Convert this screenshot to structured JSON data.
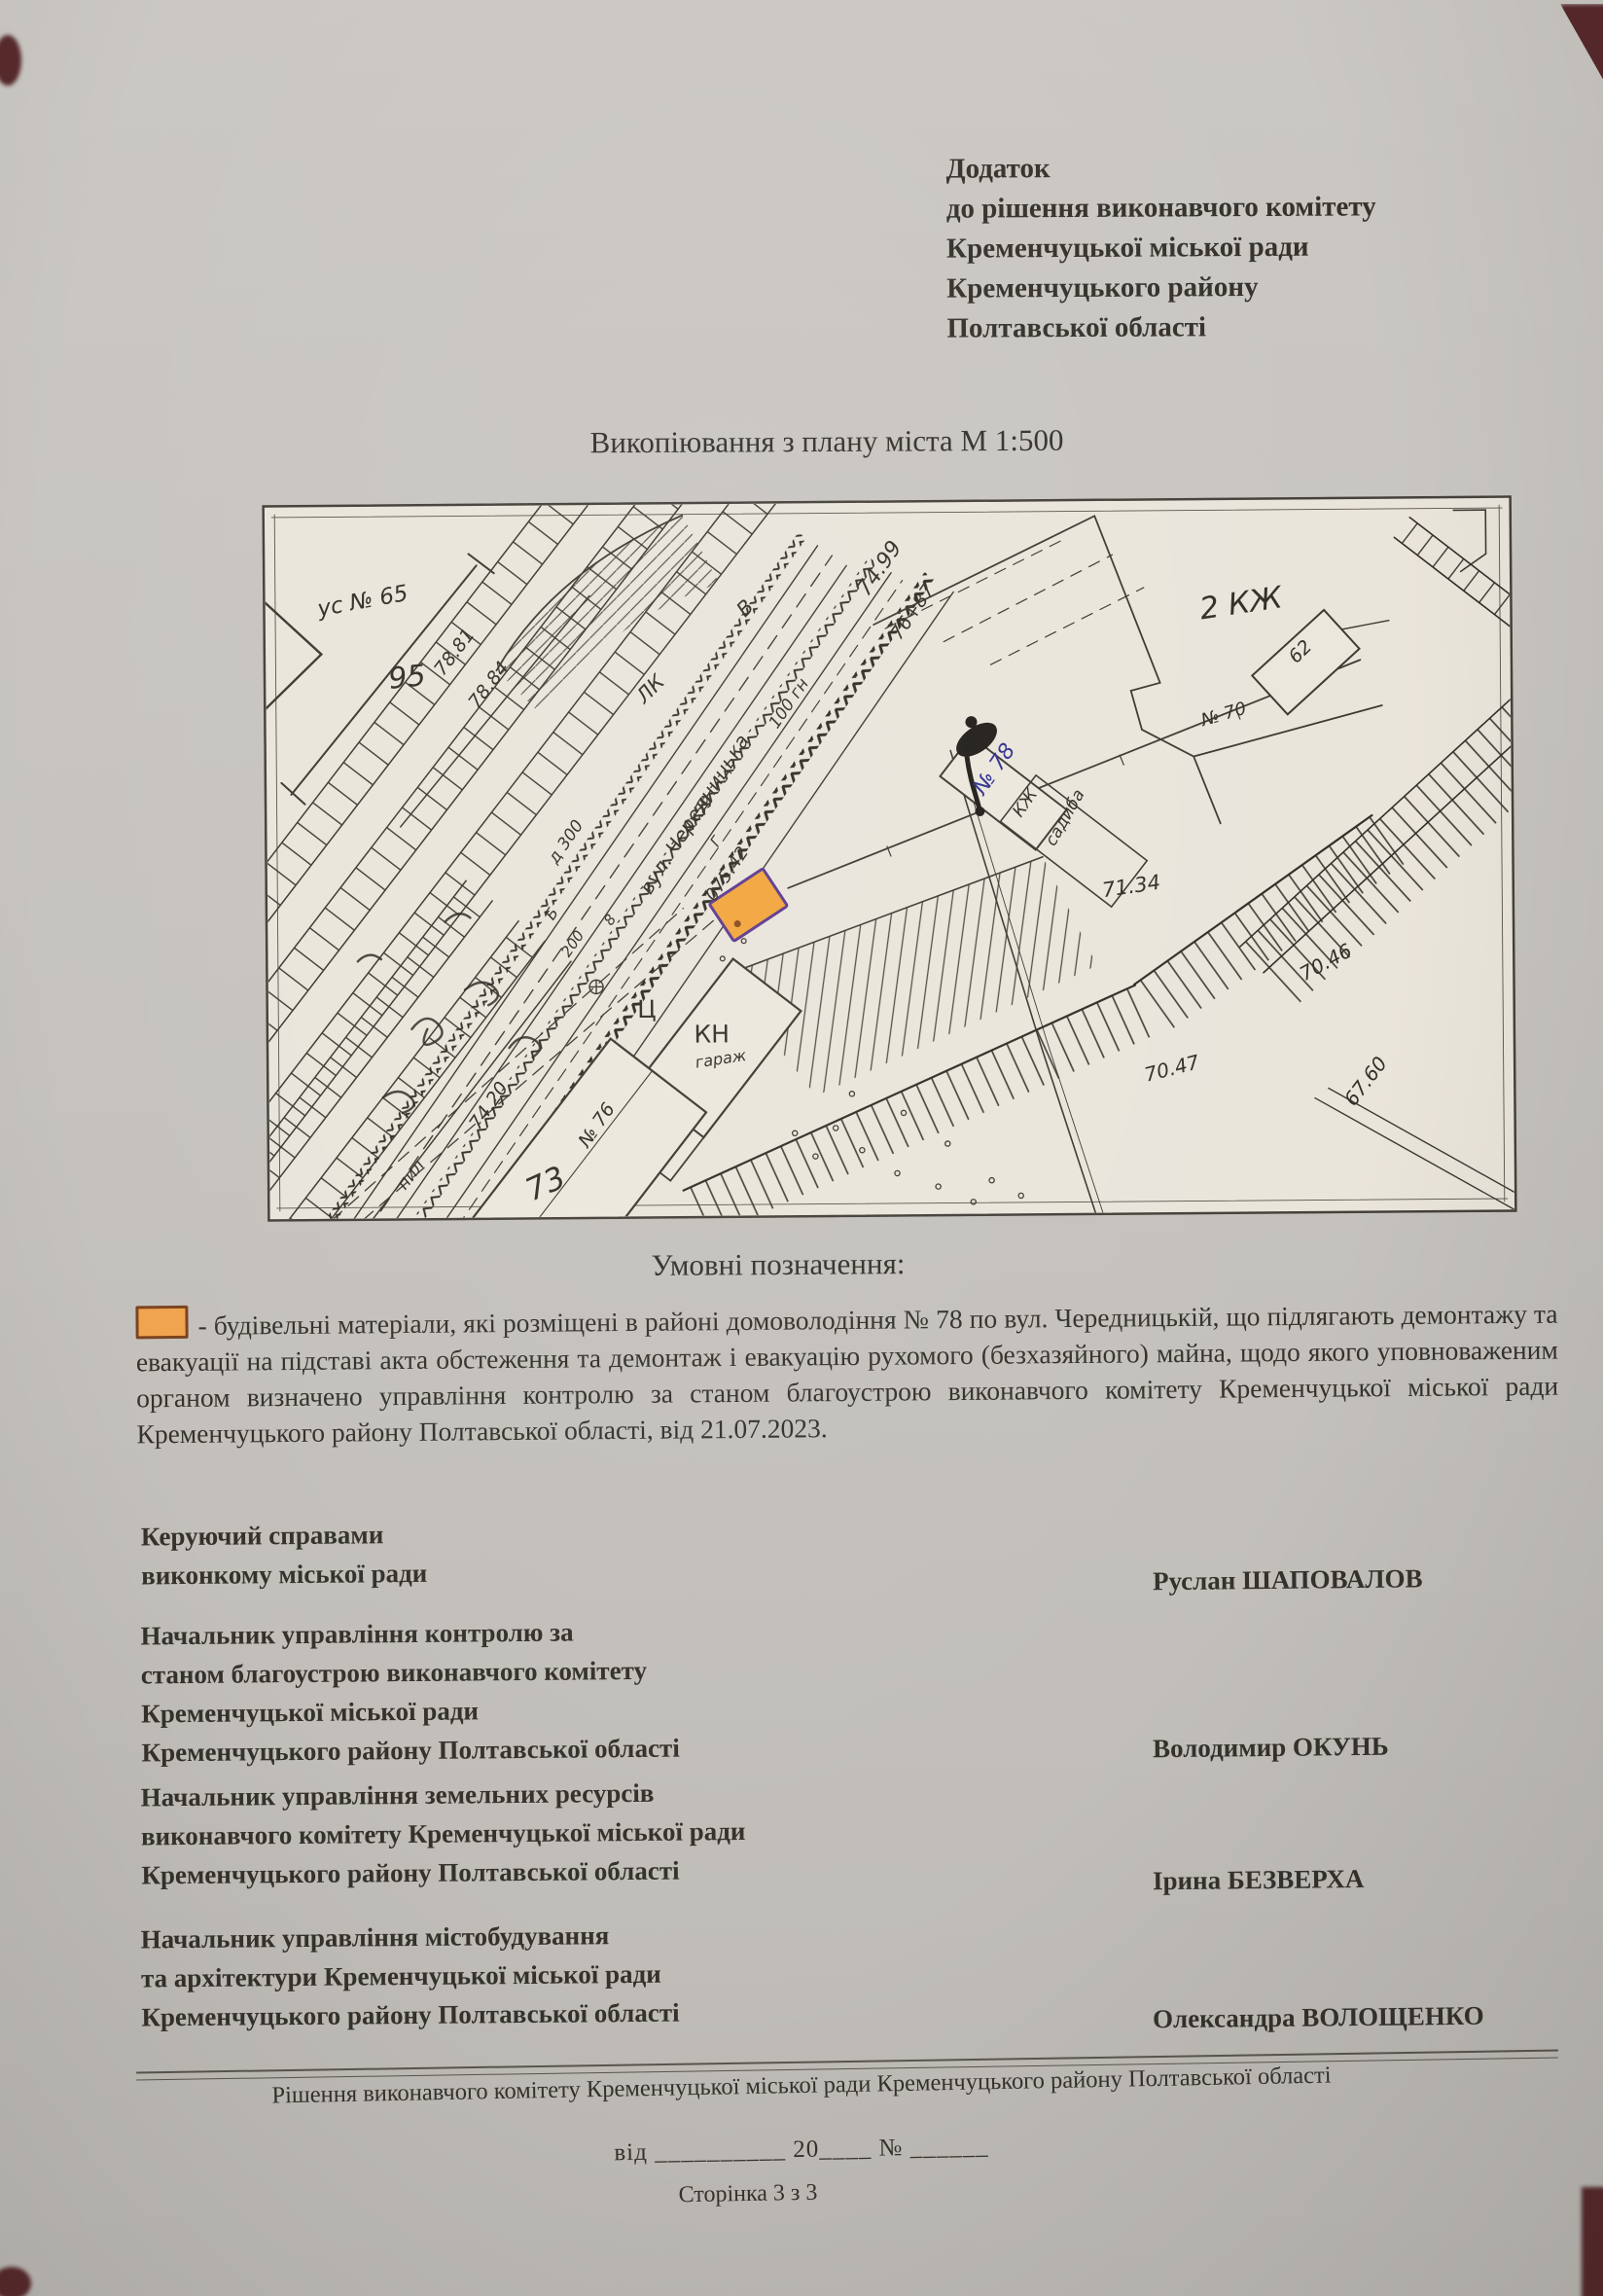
{
  "header": {
    "lines": [
      "Додаток",
      "до рішення виконавчого комітету",
      "Кременчуцької міської ради",
      "Кременчуцького району",
      "Полтавської області"
    ]
  },
  "map": {
    "title": "Викопіювання з плану міста М 1:500",
    "marker_color": "#f2a53c",
    "labels": [
      {
        "t": "ус № 65"
      },
      {
        "t": "95"
      },
      {
        "t": "78.81"
      },
      {
        "t": "78.84"
      },
      {
        "t": "ЛК"
      },
      {
        "t": "В"
      },
      {
        "t": "74.99"
      },
      {
        "t": "76+87"
      },
      {
        "t": "вул. Чередницька"
      },
      {
        "t": "100 гн"
      },
      {
        "t": "4х59"
      },
      {
        "t": "д 300"
      },
      {
        "t": "200"
      },
      {
        "t": "075.42"
      },
      {
        "t": "Ц"
      },
      {
        "t": "КН"
      },
      {
        "t": "гараж"
      },
      {
        "t": "74.20"
      },
      {
        "t": "пил"
      },
      {
        "t": "73"
      },
      {
        "t": "№ 76"
      },
      {
        "t": "№ 78"
      },
      {
        "t": "КЖ"
      },
      {
        "t": "садиба"
      },
      {
        "t": "71.34"
      },
      {
        "t": "2 КЖ"
      },
      {
        "t": "62"
      },
      {
        "t": "№ 70"
      },
      {
        "t": "70.46"
      },
      {
        "t": "70.47"
      },
      {
        "t": "67.60"
      },
      {
        "t": "Б"
      },
      {
        "t": "Г"
      },
      {
        "t": "8"
      }
    ]
  },
  "legend": {
    "title": "Умовні позначення:",
    "swatch_color": "#f0a44f",
    "paragraph": "- будівельні матеріали, які розміщені в районі домоволодіння № 78 по вул. Чередницькій, що підлягають демонтажу та евакуації на підставі акта обстеження та демонтаж і евакуацію рухомого (безхазяйного) майна, щодо якого уповноваженим органом визначено управління контролю за станом благоустрою виконавчого комітету Кременчуцької міської ради Кременчуцького району Полтавської області, від 21.07.2023."
  },
  "signatures": [
    {
      "title_lines": [
        "Керуючий справами",
        "виконкому міської ради"
      ],
      "name": "Руслан ШАПОВАЛОВ"
    },
    {
      "title_lines": [
        "Начальник управління контролю за",
        "станом благоустрою виконавчого комітету",
        "Кременчуцької міської ради",
        "Кременчуцького району Полтавської області"
      ],
      "name": "Володимир ОКУНЬ"
    },
    {
      "title_lines": [
        "Начальник управління земельних ресурсів",
        "виконавчого комітету Кременчуцької міської ради",
        "Кременчуцького району Полтавської області"
      ],
      "name": "Ірина БЕЗВЕРХА"
    },
    {
      "title_lines": [
        "Начальник управління містобудування",
        "та архітектури Кременчуцької міської ради",
        "Кременчуцького району Полтавської області"
      ],
      "name": "Олександра ВОЛОЩЕНКО"
    }
  ],
  "footer": {
    "decision_line": "Рішення виконавчого комітету Кременчуцької міської ради Кременчуцького району Полтавської області",
    "date_line": "від __________ 20____  № ______",
    "page_label": "Сторінка 3 з 3"
  }
}
